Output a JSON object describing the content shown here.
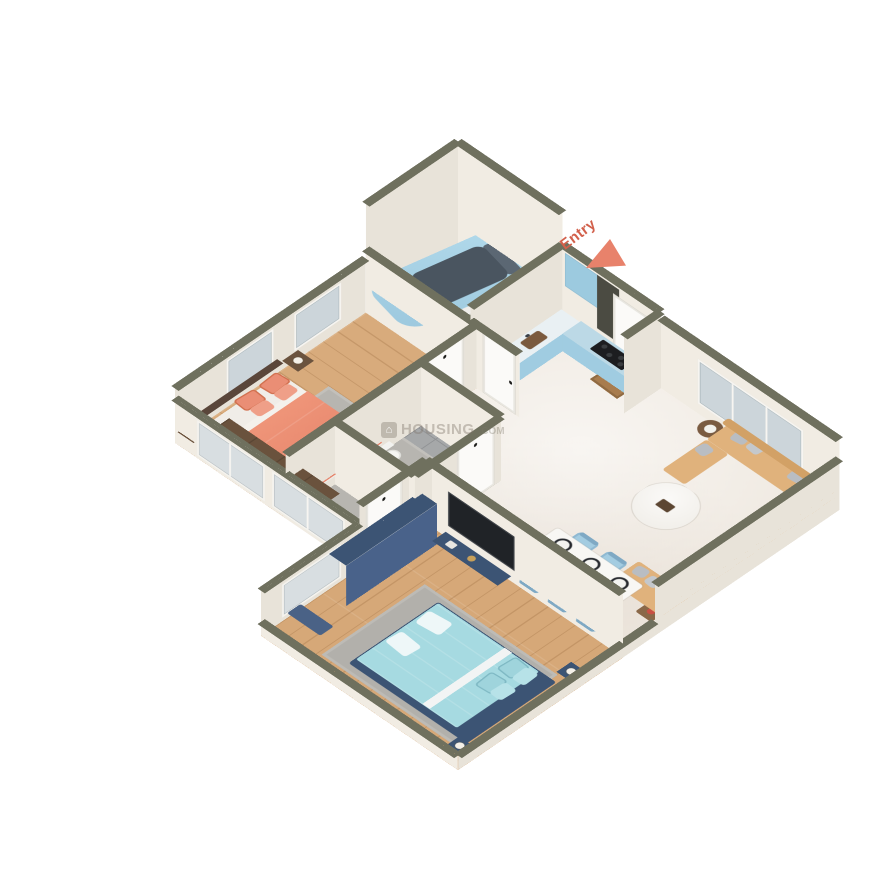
{
  "entry": {
    "label": "Entry"
  },
  "watermark": {
    "logo": "house-icon",
    "brand": "HOUSING",
    "suffix": ".COM"
  },
  "colors": {
    "background": "#ffffff",
    "wall_top": "#6f705e",
    "wall_face": "#f1ece3",
    "floor_marble": "#f0eae2",
    "floor_wood": "#d8ab7c",
    "floor_tile": "#a6a8a9",
    "kitchen_cabinet_blue": "#a9d4e7",
    "chimney_dark": "#4b4b42",
    "sofa_tan": "#e0b27c",
    "cushion_gray": "#b9bdc2",
    "master_bed_coral": "#e98b72",
    "headboard_brown": "#5a463a",
    "wardrobe_brown": "#6a523d",
    "bed2_frame_blue": "#3c5474",
    "bed2_aqua": "#a6dae1",
    "dining_chair_blue": "#a3cce1",
    "car_blue": "#a6d2e6",
    "rug_gray": "#b3b1ac",
    "entry_accent": "#d2604b",
    "entry_arrow": "#e8826b"
  },
  "rooms": [
    {
      "name": "staircase-porch",
      "features": [
        "staircase",
        "hatchback-car"
      ]
    },
    {
      "name": "kitchen",
      "features": [
        "blue-base-cabinets",
        "sink",
        "cooktop",
        "chimney-hood",
        "refrigerator",
        "upper-cabinets"
      ]
    },
    {
      "name": "living-room",
      "features": [
        "u-shaped-tan-sofa",
        "gray-cushions",
        "round-marble-coffee-table",
        "round-side-table",
        "corner-table",
        "entry-door",
        "doormat",
        "windows"
      ]
    },
    {
      "name": "dining-area",
      "features": [
        "six-seat-table",
        "blue-chairs",
        "six-place-settings"
      ]
    },
    {
      "name": "master-bedroom",
      "features": [
        "double-bed-coral-bedding",
        "brown-headboard",
        "two-nightstands",
        "table-lamps",
        "wardrobe",
        "gray-rug",
        "windows"
      ]
    },
    {
      "name": "bathroom",
      "features": [
        "toilet",
        "wash-basin",
        "shower",
        "floor-drain",
        "gray-tile-floor"
      ]
    },
    {
      "name": "bedroom-2",
      "features": [
        "double-bed-aqua-bedding",
        "blue-bed-frame",
        "two-nightstands",
        "blue-wardrobe",
        "tv-panel",
        "tv-console",
        "bench",
        "gray-rug"
      ]
    }
  ]
}
